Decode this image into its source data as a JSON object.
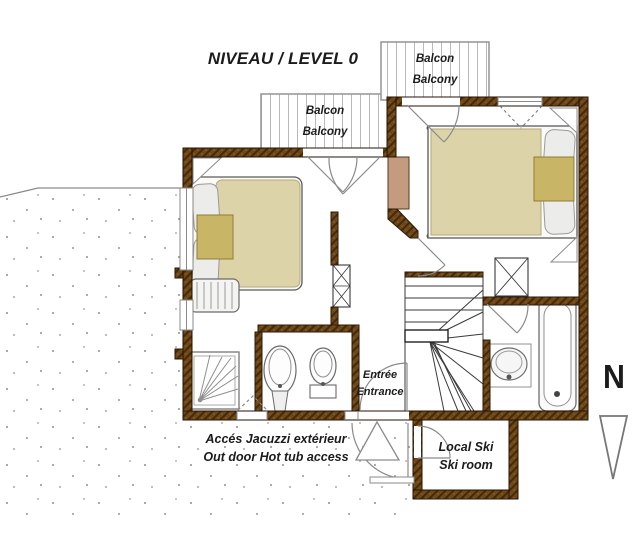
{
  "title": "NIVEAU / LEVEL 0",
  "compass": "N",
  "labels": {
    "balcony": {
      "fr": "Balcon",
      "en": "Balcony"
    },
    "entrance": {
      "fr": "Entrée",
      "en": "Entrance"
    },
    "hot_tub_access": {
      "fr": "Accés Jacuzzi extérieur",
      "en": "Out door Hot tub access"
    },
    "ski_room": {
      "fr": "Local Ski",
      "en": "Ski room"
    }
  },
  "colors": {
    "wall_brown": "#6e4719",
    "wall_brown_dark": "#432708",
    "duvet_tan": "#ddd3a8",
    "blanket_gold": "#c9b566",
    "chimney_tan": "#c59b80",
    "terrain_dot": "#909090",
    "fixture_line": "#777777"
  }
}
